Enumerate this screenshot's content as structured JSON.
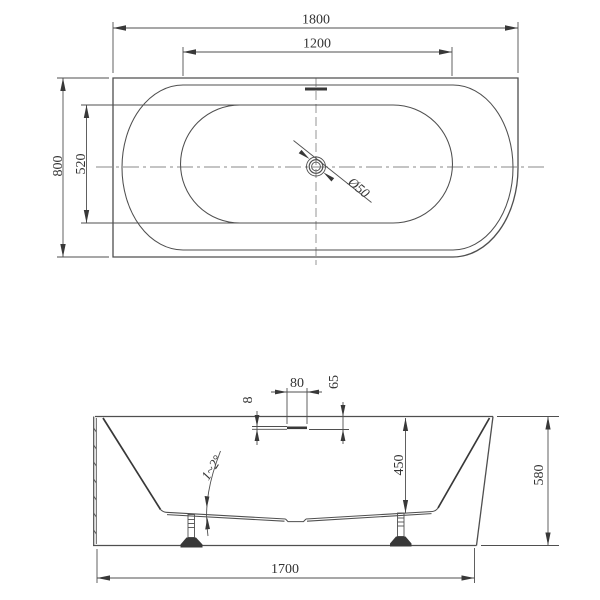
{
  "plan": {
    "overall_length": "1800",
    "inner_length": "1200",
    "overall_width": "800",
    "inner_width": "520",
    "drain_diameter": "Ø50"
  },
  "elevation": {
    "overflow_width": "80",
    "rim_to_overflow": "65",
    "overflow_slot_height": "8",
    "inner_depth": "450",
    "overall_height": "580",
    "base_length": "1700",
    "floor_slope_angle": "1~2°"
  },
  "colors": {
    "background": "#ffffff",
    "line": "#4f4f4f",
    "line-dark": "#383838",
    "text": "#333333"
  }
}
